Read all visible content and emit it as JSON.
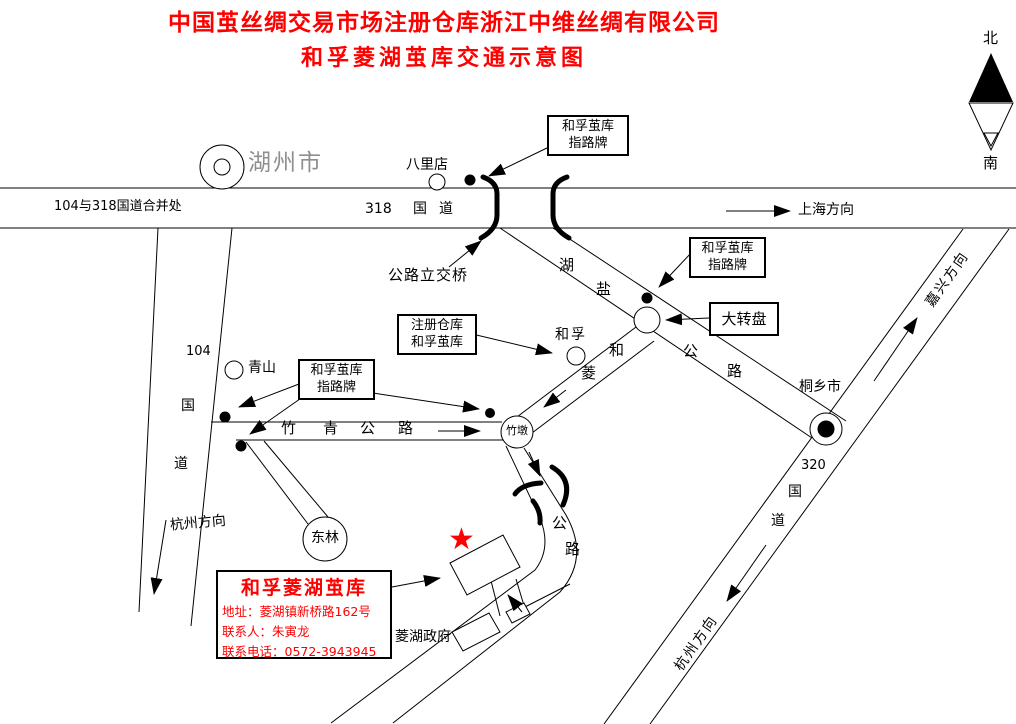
{
  "title": {
    "line1": "中国茧丝绸交易市场注册仓库浙江中维丝绸有限公司",
    "line2": "和孚菱湖茧库交通示意图"
  },
  "compass": {
    "north": "北",
    "south": "南"
  },
  "icons": {
    "star": "★"
  },
  "places": {
    "huzhou": "湖州市",
    "balidian": "八里店",
    "qingshan": "青山",
    "hefu": "和孚",
    "zhudun": "竹墩",
    "donglin": "东林",
    "tongxiang": "桐乡市",
    "linghu_gov": "菱湖政府"
  },
  "roads": {
    "merge_note": "104与318国道合并处",
    "g318": [
      "318",
      "国",
      "道"
    ],
    "shanghai_dir": "上海方向",
    "interchange": "公路立交桥",
    "huyan": [
      "湖",
      "盐",
      "公",
      "路"
    ],
    "g104": [
      "104",
      "国",
      "道"
    ],
    "hangzhou_dir_left": "杭州方向",
    "zhuqing": [
      "竹",
      "青",
      "公",
      "路"
    ],
    "heling": [
      "和",
      "菱",
      "公",
      "路"
    ],
    "g320": [
      "320",
      "国",
      "道"
    ],
    "jiaxing_dir": "嘉兴方向",
    "hangzhou_dir_right": "杭州方向"
  },
  "signs": {
    "guideboard": {
      "line1": "和孚茧库",
      "line2": "指路牌"
    },
    "roundabout": "大转盘",
    "registered": {
      "line1": "注册仓库",
      "line2": "和孚茧库"
    }
  },
  "infobox": {
    "title": "和孚菱湖茧库",
    "address": "地址：菱湖镇新桥路162号",
    "contact": "联系人：朱寅龙",
    "phone": "联系电话：0572-3943945"
  },
  "colors": {
    "accent_red": "#ff0000",
    "ink": "#000000",
    "city_gray": "#8f8f8f"
  }
}
